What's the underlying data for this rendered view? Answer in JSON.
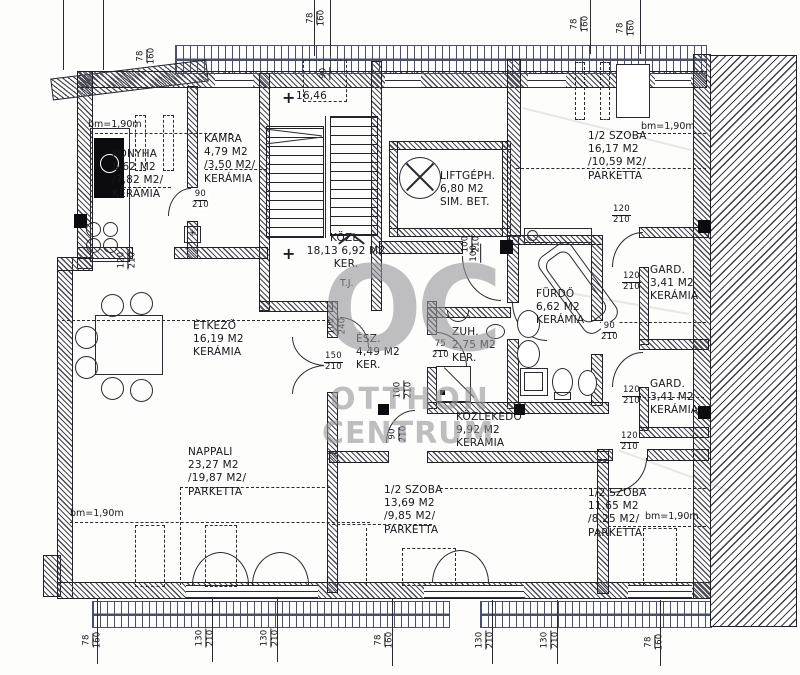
{
  "watermark": {
    "logo": "OC",
    "line1": "OTTHON",
    "line2": "CENTRUM"
  },
  "rooms": {
    "konyha": {
      "name": "KONYHA",
      "area": "8,62 M2",
      "net": "/7,82 M2/",
      "floor": "KERÁMIA"
    },
    "kamra": {
      "name": "KAMRA",
      "area": "4,79 M2",
      "net": "/3,50 M2/",
      "floor": "KERÁMIA"
    },
    "kozl": {
      "name": "KÖZL.",
      "area": "18,13 6,92 M2",
      "floor": "KER."
    },
    "liftgeph": {
      "name": "LIFTGÉPH.",
      "area": "6,80 M2",
      "floor": "SIM. BET."
    },
    "szoba_tr": {
      "name": "1/2 SZOBA",
      "area": "16,17 M2",
      "net": "/10,59 M2/",
      "floor": "PARKETTA"
    },
    "etkezo": {
      "name": "ÉTKEZŐ",
      "area": "16,19 M2",
      "floor": "KERÁMIA"
    },
    "elosz": {
      "name": "ÉSZ.",
      "area": "4,49 M2",
      "floor": "KER."
    },
    "zuh": {
      "name": "ZUH.",
      "area": "2,75 M2",
      "floor": "KER."
    },
    "furdo": {
      "name": "FÜRDŐ",
      "area": "6,62 M2",
      "floor": "KERÁMIA"
    },
    "gard1": {
      "name": "GARD.",
      "area": "3,41 M2",
      "floor": "KERÁMIA"
    },
    "gard2": {
      "name": "GARD.",
      "area": "3,41 M2",
      "floor": "KERÁMIA"
    },
    "kozlekedo": {
      "name": "KÖZLEKEDŐ",
      "area": "9,92 M2",
      "floor": "KERÁMIA"
    },
    "nappali": {
      "name": "NAPPALI",
      "area": "23,27 M2",
      "net": "/19,87 M2/",
      "floor": "PARKETTA"
    },
    "szoba_bm": {
      "name": "1/2 SZOBA",
      "area": "13,69 M2",
      "net": "/9,85 M2/",
      "floor": "PARKETTA"
    },
    "szoba_br": {
      "name": "1/2 SZOBA",
      "area": "11,65 M2",
      "net": "/8,25 M2/",
      "floor": "PARKETTA"
    }
  },
  "annotations": {
    "bm_height": "bm=1,90m",
    "stair_level": "16,46",
    "tj": "T.J.",
    "star": "✳"
  },
  "dims": {
    "d78_160": {
      "t": "78",
      "b": "160"
    },
    "d130_210": {
      "t": "130",
      "b": "210"
    },
    "d120_210": {
      "t": "120",
      "b": "210"
    },
    "d90_210": {
      "t": "90",
      "b": "210"
    },
    "d150_210": {
      "t": "150",
      "b": "210"
    },
    "d100_210": {
      "t": "100",
      "b": "210"
    },
    "d100_240": {
      "t": "100",
      "b": "240"
    },
    "d75_210": {
      "t": "75",
      "b": "210"
    },
    "d90": {
      "t": "90"
    },
    "d100": {
      "t": "100"
    }
  }
}
